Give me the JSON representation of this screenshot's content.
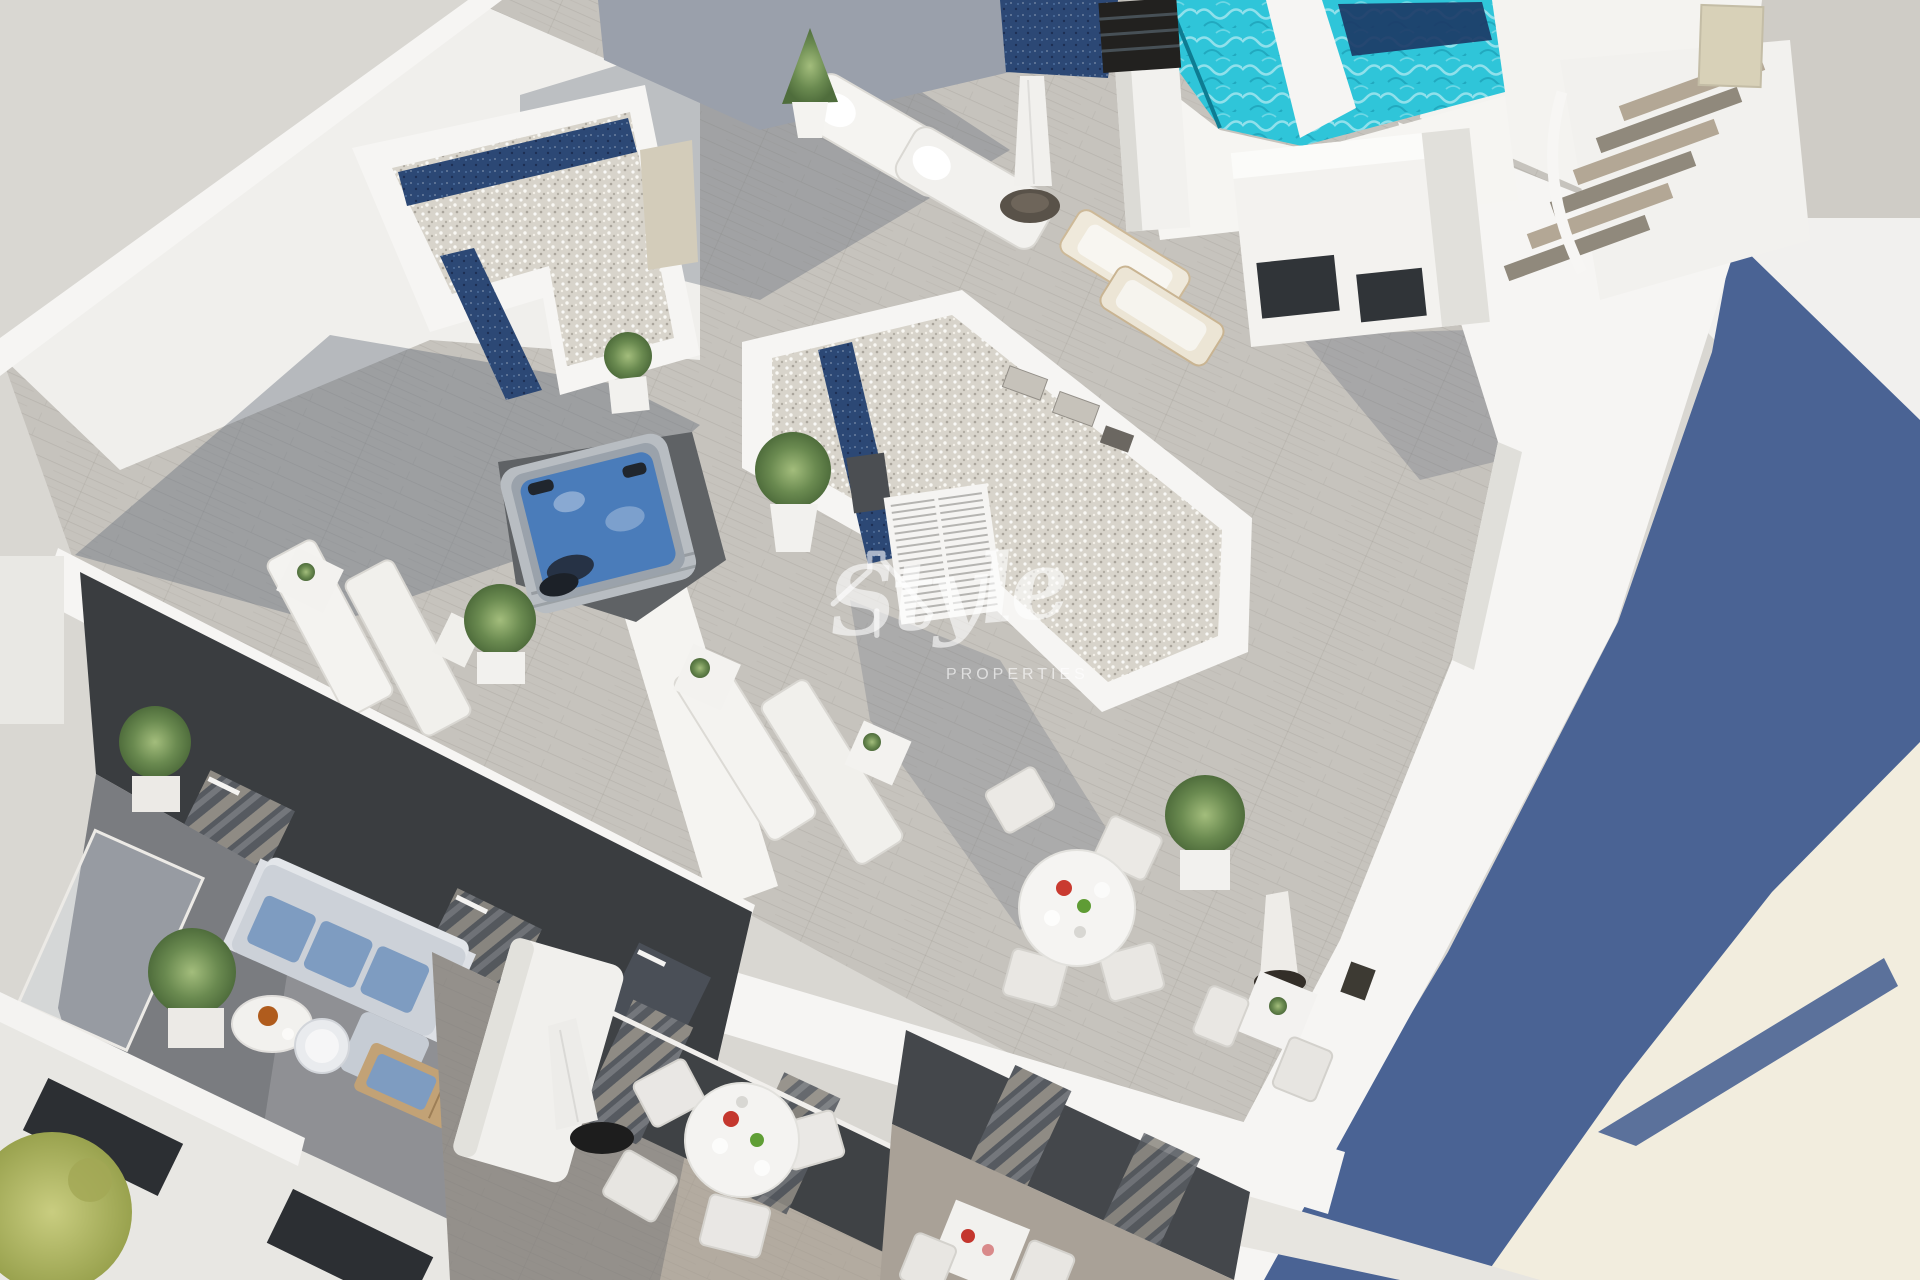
{
  "watermark": {
    "script_text": "Style",
    "subtext": "PROPERTIES",
    "icon": "roof-outline-icon",
    "text_color": "#ffffff",
    "opacity": 0.6
  },
  "colors": {
    "background_gray": "#d9d7d2",
    "background_strip": "#cfccc6",
    "background_white": "#f1f0ee",
    "shadow_blue": "#4a6394",
    "sunlit_cream": "#f2edde",
    "white_wall": "#f6f5f3",
    "wall_shade": "#e0dfda",
    "deck_wood": "#c6c3bd",
    "gravel": "#d8d4cb",
    "skylight_navy": "#2c4875",
    "pool_turquoise": "#2fc5d9",
    "jacuzzi_blue": "#4a7cba",
    "facade_charcoal": "#3a3d40",
    "cushion_blue": "#7e9cc1",
    "wood_tan": "#c2a276",
    "plant_green": "#6a8a50",
    "umbrella_white": "#efeeea"
  }
}
